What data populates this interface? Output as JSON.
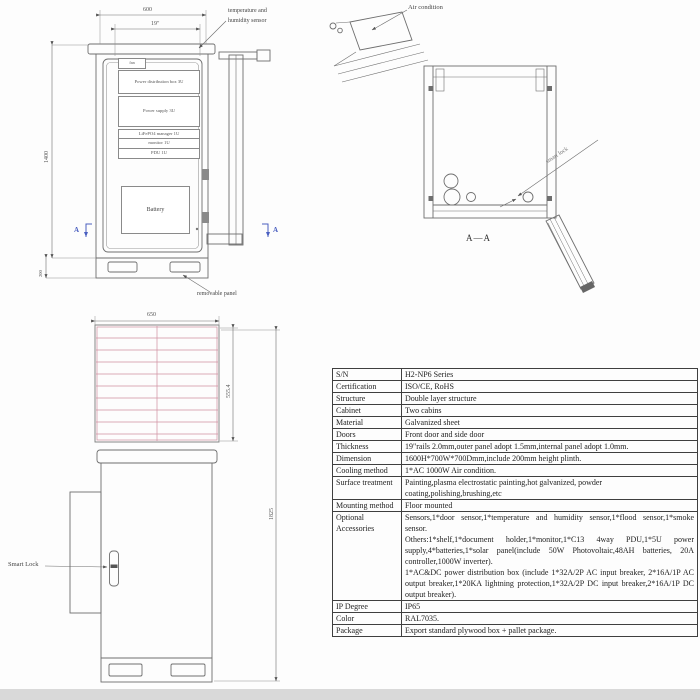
{
  "drawing": {
    "front_view": {
      "dim_width": "600",
      "dim_rack_width": "19\"",
      "dim_height": "1400",
      "dim_plinth": "200",
      "sensor_label_line1": "temperature and",
      "sensor_label_line2": "humidity sensor",
      "fan_label": "fan",
      "components": [
        "Power distribution box 3U",
        "Power supply 3U",
        "LiFePO4 manager 1U",
        "monitor 1U",
        "PDU 1U"
      ],
      "battery_label": "Battery",
      "removable_panel_label": "removable panel",
      "section_marker_left": "A",
      "section_marker_right": "A"
    },
    "section_view": {
      "air_condition_label": "Air condition",
      "lock_label": "smart lock",
      "caption": "A—A"
    },
    "side_view": {
      "dim_width": "650",
      "dim_panel_height": "555.4",
      "dim_total_height": "1825",
      "smart_lock_label": "Smart Lock"
    },
    "colors": {
      "section_marker_blue": "#4a5fc0",
      "solar_grid_pink": "#cf8fa0",
      "line_gray": "#6e6e6e"
    }
  },
  "table": {
    "rows": [
      {
        "label": "S/N",
        "value": "H2-NP6 Series"
      },
      {
        "label": "Certification",
        "value": "ISO/CE, RoHS"
      },
      {
        "label": "Structure",
        "value": "Double layer structure"
      },
      {
        "label": "Cabinet",
        "value": "Two cabins"
      },
      {
        "label": "Material",
        "value": "Galvanized sheet"
      },
      {
        "label": "Doors",
        "value": "Front door and side door"
      },
      {
        "label": "Thickness",
        "value": "19\"rails 2.0mm,outer panel adopt 1.5mm,internal panel adopt 1.0mm."
      },
      {
        "label": "Dimension",
        "value": "1600H*700W*700Dmm,include 200mm height plinth."
      },
      {
        "label": "Cooling method",
        "value": "1*AC 1000W Air condition."
      },
      {
        "label": "Surface treatment",
        "value": "Painting,plasma electrostatic painting,hot galvanized, powder coating,polishing,brushing,etc"
      },
      {
        "label": "Mounting method",
        "value": "Floor mounted"
      },
      {
        "label": "Optional Accessories",
        "value": [
          "Sensors,1*door sensor,1*temperature and humidity sensor,1*flood sensor,1*smoke sensor.",
          "Others:1*shelf,1*document holder,1*monitor,1*C13 4way PDU,1*5U power supply,4*batteries,1*solar panel(include 50W Photovoltaic,48AH batteries, 20A controller,1000W inverter).",
          "1*AC&DC power distribution box (include 1*32A/2P AC input breaker, 2*16A/1P AC output breaker,1*20KA lightning protection,1*32A/2P DC input breaker,2*16A/1P DC output breaker)."
        ]
      },
      {
        "label": "IP Degree",
        "value": "IP65"
      },
      {
        "label": "Color",
        "value": "RAL7035."
      },
      {
        "label": "Package",
        "value": "Export standard plywood box + pallet package."
      }
    ]
  }
}
